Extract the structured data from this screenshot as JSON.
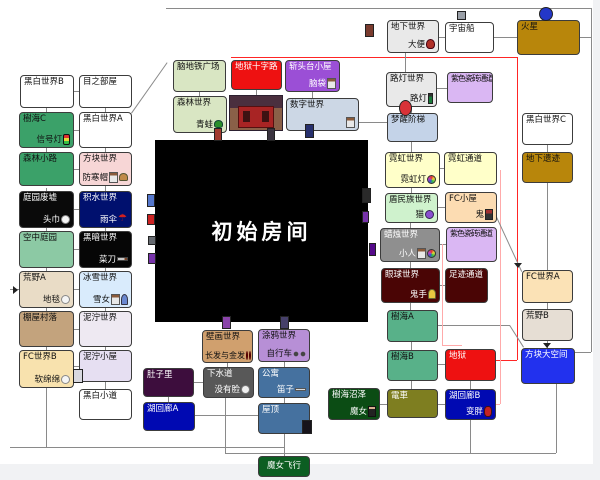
{
  "nexus_label": "初始房间",
  "colors": {
    "line": "#8a8a8a",
    "special_route_red": "#ff2525",
    "special_route_pink": "#ffaaaa",
    "nexus_bg": "#000000"
  },
  "nodes": [
    {
      "id": "blackwhite-b",
      "label": "黑白世界B",
      "x": 20,
      "y": 75,
      "w": 54,
      "h": 33,
      "bg": "#ffffff"
    },
    {
      "id": "jukai-c",
      "label": "樹海C",
      "item": "信号灯",
      "icons": [
        "stoplight-icon"
      ],
      "x": 19,
      "y": 112,
      "w": 55,
      "h": 36,
      "bg": "#3ba169"
    },
    {
      "id": "forest-path",
      "label": "森林小路",
      "x": 19,
      "y": 152,
      "w": 55,
      "h": 34,
      "bg": "#3ba169"
    },
    {
      "id": "garden-ruins",
      "label": "庭园废墟",
      "item": "头巾",
      "icons": [
        "towel-icon"
      ],
      "x": 19,
      "y": 191,
      "w": 55,
      "h": 37,
      "bg": "#0a0a0a",
      "fg": "#ffffff"
    },
    {
      "id": "sky-garden",
      "label": "空中庭园",
      "x": 19,
      "y": 231,
      "w": 55,
      "h": 37,
      "bg": "#8cc9a4"
    },
    {
      "id": "wilderness-a",
      "label": "荒野A",
      "item": "地毯",
      "icons": [
        "rug-icon"
      ],
      "x": 19,
      "y": 271,
      "w": 55,
      "h": 37,
      "bg": "#e9dcc6"
    },
    {
      "id": "hut-village",
      "label": "棚屋村落",
      "x": 19,
      "y": 311,
      "w": 55,
      "h": 36,
      "bg": "#c3a37d"
    },
    {
      "id": "fc-world-b",
      "label": "FC世界B",
      "item": "软绵绵",
      "icons": [
        "blob-icon"
      ],
      "x": 19,
      "y": 350,
      "w": 55,
      "h": 38,
      "bg": "#f8e2ae"
    },
    {
      "id": "eye-room",
      "label": "目之部屋",
      "x": 79,
      "y": 75,
      "w": 53,
      "h": 33,
      "bg": "#ffffff"
    },
    {
      "id": "blackwhite-a",
      "label": "黑白世界A",
      "x": 79,
      "y": 112,
      "w": 53,
      "h": 36,
      "bg": "#ffffff"
    },
    {
      "id": "block-world",
      "label": "方块世界",
      "item": "防寒帽",
      "icons": [
        "bed-icon",
        "hat-icon"
      ],
      "x": 79,
      "y": 152,
      "w": 53,
      "h": 34,
      "bg": "#f7d6d6"
    },
    {
      "id": "puddle-world",
      "label": "积水世界",
      "item": "雨伞",
      "icons": [
        "umbrella-icon"
      ],
      "x": 79,
      "y": 191,
      "w": 53,
      "h": 37,
      "bg": "#00106e",
      "fg": "#ffffff"
    },
    {
      "id": "dark-world",
      "label": "黑暗世界",
      "item": "菜刀",
      "icons": [
        "knife-icon"
      ],
      "x": 79,
      "y": 231,
      "w": 53,
      "h": 37,
      "bg": "#060606",
      "fg": "#ffffff"
    },
    {
      "id": "snow-world",
      "label": "冰雪世界",
      "item": "雪女",
      "icons": [
        "bed-icon",
        "person-icon"
      ],
      "x": 79,
      "y": 271,
      "w": 53,
      "h": 37,
      "bg": "#d9ebfc"
    },
    {
      "id": "mud-world",
      "label": "泥泞世界",
      "x": 79,
      "y": 311,
      "w": 53,
      "h": 36,
      "bg": "#eee9f2"
    },
    {
      "id": "mud-hut",
      "label": "泥泞小屋",
      "x": 79,
      "y": 350,
      "w": 53,
      "h": 32,
      "bg": "#e6dff2"
    },
    {
      "id": "blackwhite-path",
      "label": "黑白小道",
      "x": 79,
      "y": 389,
      "w": 53,
      "h": 31,
      "bg": "#ffffff"
    },
    {
      "id": "brain-plaza",
      "label": "脑地铁广场",
      "x": 173,
      "y": 60,
      "w": 53,
      "h": 32,
      "bg": "#d9e6c3"
    },
    {
      "id": "hell-crossroad",
      "label": "地狱十字路",
      "x": 231,
      "y": 60,
      "w": 51,
      "h": 30,
      "bg": "#ee1111",
      "fg": "#ffffff"
    },
    {
      "id": "guillotine-hut",
      "label": "斩头台小屋",
      "item": "脑袋",
      "icons": [
        "bed-icon"
      ],
      "x": 285,
      "y": 60,
      "w": 55,
      "h": 32,
      "bg": "#9b4fd6",
      "fg": "#ffffff"
    },
    {
      "id": "forest-world",
      "label": "森林世界",
      "item": "青蛙",
      "icons": [
        "frog-icon"
      ],
      "x": 173,
      "y": 96,
      "w": 54,
      "h": 37,
      "bg": "#d9e6c3"
    },
    {
      "id": "number-world",
      "label": "数字世界",
      "item": "",
      "icons": [
        "bed-icon"
      ],
      "x": 286,
      "y": 98,
      "w": 73,
      "h": 33,
      "bg": "#ccd7e5"
    },
    {
      "id": "underground-world",
      "label": "地下世界",
      "item": "大便",
      "icons": [
        "poop-icon"
      ],
      "x": 387,
      "y": 20,
      "w": 52,
      "h": 33,
      "bg": "#e9e9e9"
    },
    {
      "id": "spaceship",
      "label": "宇宙船",
      "x": 445,
      "y": 22,
      "w": 49,
      "h": 31,
      "bg": "#ffffff"
    },
    {
      "id": "mars",
      "label": "火星",
      "x": 517,
      "y": 20,
      "w": 63,
      "h": 35,
      "bg": "#b8860b"
    },
    {
      "id": "lamp-world",
      "label": "路灯世界",
      "item": "路灯",
      "icons": [
        "lamp-icon"
      ],
      "x": 386,
      "y": 72,
      "w": 51,
      "h": 35,
      "bg": "#e9e9e9"
    },
    {
      "id": "purple-tile-passage-1",
      "label": "紫色瓷砖通道",
      "x": 447,
      "y": 72,
      "w": 46,
      "h": 31,
      "bg": "#dab7f3",
      "cls": "tight"
    },
    {
      "id": "dream-stairs",
      "label": "梦醒阶梯",
      "x": 387,
      "y": 113,
      "w": 51,
      "h": 29,
      "bg": "#c4d3e8"
    },
    {
      "id": "neon-world",
      "label": "霓虹世界",
      "item": "霓虹灯",
      "icons": [
        "neon-icon"
      ],
      "x": 385,
      "y": 152,
      "w": 55,
      "h": 36,
      "bg": "#ffffc9"
    },
    {
      "id": "neon-passage",
      "label": "霓虹通道",
      "x": 444,
      "y": 152,
      "w": 53,
      "h": 33,
      "bg": "#ffffc9"
    },
    {
      "id": "shield-tribe-world",
      "label": "盾民族世界",
      "item": "猫",
      "icons": [
        "cat-icon"
      ],
      "x": 385,
      "y": 193,
      "w": 53,
      "h": 30,
      "bg": "#cff2cd"
    },
    {
      "id": "fc-hut",
      "label": "FC小屋",
      "item": "鬼",
      "icons": [
        "demon-icon"
      ],
      "x": 445,
      "y": 192,
      "w": 52,
      "h": 31,
      "bg": "#fcdcb2"
    },
    {
      "id": "candle-world",
      "label": "蜡烛世界",
      "item": "小人",
      "icons": [
        "bed-icon",
        "ball-icon"
      ],
      "x": 380,
      "y": 228,
      "w": 60,
      "h": 34,
      "bg": "#8f8f8f",
      "fg": "#ffffff"
    },
    {
      "id": "purple-tile-passage-2",
      "label": "紫色瓷砖通道",
      "x": 446,
      "y": 227,
      "w": 51,
      "h": 35,
      "bg": "#dab7f3",
      "cls": "tight"
    },
    {
      "id": "eyeball-world",
      "label": "眼球世界",
      "item": "鬼手",
      "icons": [
        "hand-icon"
      ],
      "x": 381,
      "y": 268,
      "w": 59,
      "h": 35,
      "bg": "#4a0505",
      "fg": "#ffffff"
    },
    {
      "id": "footprint-passage",
      "label": "足迹通道",
      "x": 445,
      "y": 268,
      "w": 43,
      "h": 35,
      "bg": "#4a0505",
      "fg": "#ffffff"
    },
    {
      "id": "blackwhite-c",
      "label": "黑白世界C",
      "x": 522,
      "y": 113,
      "w": 51,
      "h": 32,
      "bg": "#ffffff"
    },
    {
      "id": "underground-ruins",
      "label": "地下遗迹",
      "x": 522,
      "y": 152,
      "w": 51,
      "h": 31,
      "bg": "#b8860b"
    },
    {
      "id": "fc-world-a",
      "label": "FC世界A",
      "x": 522,
      "y": 270,
      "w": 51,
      "h": 33,
      "bg": "#fbe2b6"
    },
    {
      "id": "wilderness-b",
      "label": "荒野B",
      "x": 522,
      "y": 309,
      "w": 51,
      "h": 32,
      "bg": "#e6ded4"
    },
    {
      "id": "block-space",
      "label": "方块大空间",
      "x": 521,
      "y": 348,
      "w": 54,
      "h": 36,
      "bg": "#2231ee",
      "fg": "#ffffff"
    },
    {
      "id": "jukai-a",
      "label": "樹海A",
      "x": 387,
      "y": 310,
      "w": 51,
      "h": 32,
      "bg": "#58b189"
    },
    {
      "id": "jukai-b",
      "label": "樹海B",
      "x": 387,
      "y": 350,
      "w": 51,
      "h": 31,
      "bg": "#58b189"
    },
    {
      "id": "hell",
      "label": "地狱",
      "x": 445,
      "y": 349,
      "w": 51,
      "h": 32,
      "bg": "#ee1111",
      "fg": "#ffffff"
    },
    {
      "id": "train",
      "label": "電車",
      "x": 387,
      "y": 389,
      "w": 51,
      "h": 29,
      "bg": "#7e7e20",
      "fg": "#ffffff"
    },
    {
      "id": "lake-corridor-b",
      "label": "湖回廊B",
      "item": "变胖",
      "icons": [
        "fat-icon"
      ],
      "x": 445,
      "y": 389,
      "w": 51,
      "h": 31,
      "bg": "#0009b2",
      "fg": "#ffffff"
    },
    {
      "id": "jukai-swamp",
      "label": "樹海沼泽",
      "item": "魔女",
      "icons": [
        "witch-icon"
      ],
      "x": 328,
      "y": 388,
      "w": 52,
      "h": 32,
      "bg": "#0b4c14",
      "fg": "#ffffff"
    },
    {
      "id": "mural-world",
      "label": "壁画世界",
      "item": "长发与金发",
      "icons": [
        "face-icon",
        "face-icon"
      ],
      "x": 202,
      "y": 330,
      "w": 51,
      "h": 33,
      "bg": "#d0a06e",
      "cls": "mural"
    },
    {
      "id": "graffiti-world",
      "label": "涂鸦世界",
      "item": "自行车",
      "icons": [
        "bike-icon"
      ],
      "x": 258,
      "y": 329,
      "w": 52,
      "h": 33,
      "bg": "#b78fd6"
    },
    {
      "id": "sewer",
      "label": "下水道",
      "item": "没有脸",
      "icons": [
        "noface-icon"
      ],
      "x": 203,
      "y": 367,
      "w": 51,
      "h": 31,
      "bg": "#585858",
      "fg": "#ffffff"
    },
    {
      "id": "apartment",
      "label": "公寓",
      "item": "笛子",
      "icons": [
        "flute-icon"
      ],
      "x": 258,
      "y": 367,
      "w": 52,
      "h": 31,
      "bg": "#45719f",
      "fg": "#ffffff"
    },
    {
      "id": "rooftop",
      "label": "屋顶",
      "x": 258,
      "y": 403,
      "w": 52,
      "h": 31,
      "bg": "#45719f",
      "fg": "#ffffff"
    },
    {
      "id": "witch-flight",
      "label": "魔女飞行",
      "x": 258,
      "y": 456,
      "w": 52,
      "h": 21,
      "bg": "#0c5e22",
      "fg": "#ffffff",
      "cls": "center"
    },
    {
      "id": "belly",
      "label": "肚子里",
      "x": 143,
      "y": 368,
      "w": 51,
      "h": 29,
      "bg": "#3d0d3d",
      "fg": "#ffffff"
    },
    {
      "id": "lake-corridor-a",
      "label": "湖回廊A",
      "x": 143,
      "y": 402,
      "w": 52,
      "h": 29,
      "bg": "#0009b2",
      "fg": "#ffffff"
    }
  ],
  "decorations": [
    {
      "name": "mars-visitor-icon",
      "x": 539,
      "y": 7,
      "w": 14,
      "h": 14,
      "color": "#2437c8",
      "round": true
    },
    {
      "name": "spaceship-top-icon",
      "x": 457,
      "y": 11,
      "w": 9,
      "h": 9,
      "color": "#9aa0a8"
    },
    {
      "name": "underground-door-icon",
      "x": 365,
      "y": 24,
      "w": 9,
      "h": 13,
      "color": "#7a3b2e"
    },
    {
      "name": "balloon-icon",
      "x": 399,
      "y": 100,
      "w": 13,
      "h": 16,
      "color": "#d83238",
      "round": true
    },
    {
      "name": "nexus-door-red-icon",
      "x": 214,
      "y": 128,
      "w": 8,
      "h": 13,
      "color": "#a23a2e"
    },
    {
      "name": "nexus-door-dark-icon",
      "x": 267,
      "y": 128,
      "w": 8,
      "h": 13,
      "color": "#3a3440"
    },
    {
      "name": "nexus-door-number-icon",
      "x": 305,
      "y": 124,
      "w": 9,
      "h": 14,
      "color": "#27306e"
    },
    {
      "name": "door-bed-icon",
      "x": 147,
      "y": 194,
      "w": 8,
      "h": 13,
      "color": "#5577cc"
    },
    {
      "name": "door-red-icon",
      "x": 147,
      "y": 214,
      "w": 8,
      "h": 11,
      "color": "#cc2222"
    },
    {
      "name": "door-gray-icon",
      "x": 148,
      "y": 236,
      "w": 8,
      "h": 9,
      "color": "#666a70"
    },
    {
      "name": "door-purple-icon",
      "x": 148,
      "y": 253,
      "w": 8,
      "h": 11,
      "color": "#7733aa"
    },
    {
      "name": "door-candle-icon",
      "x": 362,
      "y": 188,
      "w": 9,
      "h": 15,
      "color": "#2a2a2a"
    },
    {
      "name": "door-violet-icon",
      "x": 362,
      "y": 211,
      "w": 7,
      "h": 12,
      "color": "#7733aa"
    },
    {
      "name": "door-deep-purple-icon",
      "x": 369,
      "y": 243,
      "w": 7,
      "h": 13,
      "color": "#550a8a"
    },
    {
      "name": "mud-hut-sprite-icon",
      "x": 73,
      "y": 369,
      "w": 10,
      "h": 14,
      "color": "#d8d8e0"
    },
    {
      "name": "rooftop-cat-icon",
      "x": 302,
      "y": 420,
      "w": 10,
      "h": 14,
      "color": "#17131a"
    },
    {
      "name": "mural-door-icon",
      "x": 222,
      "y": 316,
      "w": 9,
      "h": 13,
      "color": "#8a44aa"
    },
    {
      "name": "graffiti-door-icon",
      "x": 280,
      "y": 316,
      "w": 9,
      "h": 13,
      "color": "#46406a"
    }
  ]
}
